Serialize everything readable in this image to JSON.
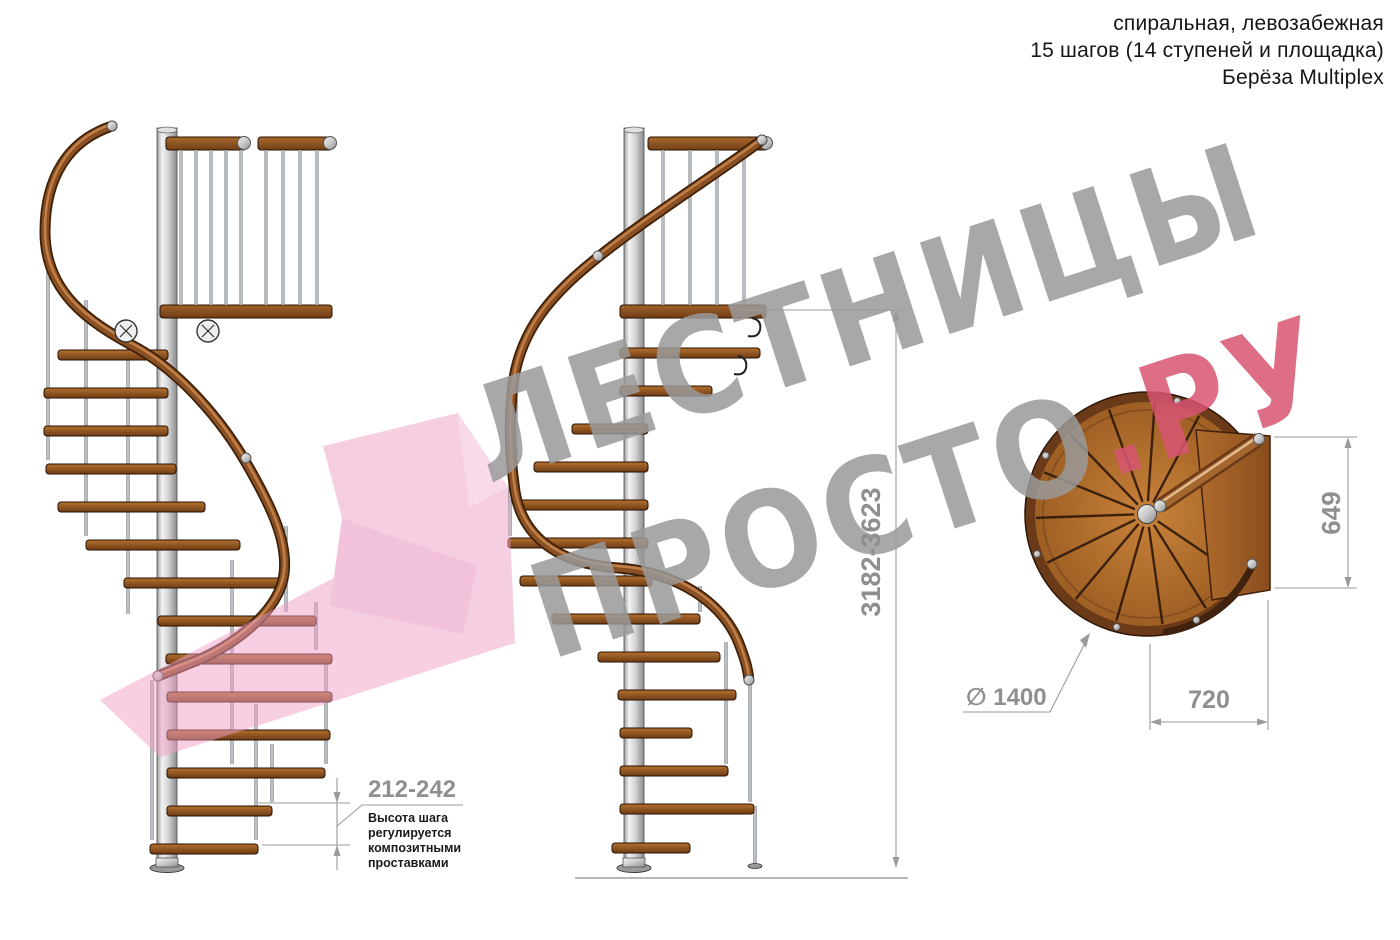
{
  "header": {
    "line1": "спиральная, левозабежная",
    "line2": "15 шагов (14 ступеней и площадка)",
    "line3": "Берёза Multiplex"
  },
  "watermark": {
    "word1": "ЛЕСТНИЦЫ",
    "word2": "ПРОСТО",
    "word2_suffix": ".РУ"
  },
  "dimensions": {
    "total_height": "3182-3623",
    "step_height": "212-242",
    "step_note": [
      "Высота шага",
      "регулируется",
      "композитными",
      "проставками"
    ],
    "plan_diameter": "∅ 1400",
    "platform_length": "649",
    "platform_width": "720"
  },
  "colors": {
    "watermark_gray": "#9a9a9a",
    "watermark_pink": "#d85572",
    "dimension_gray": "#9b9b9b",
    "wood_brown": "#8a4f1e",
    "metal_silver": "#cfcfcf"
  }
}
